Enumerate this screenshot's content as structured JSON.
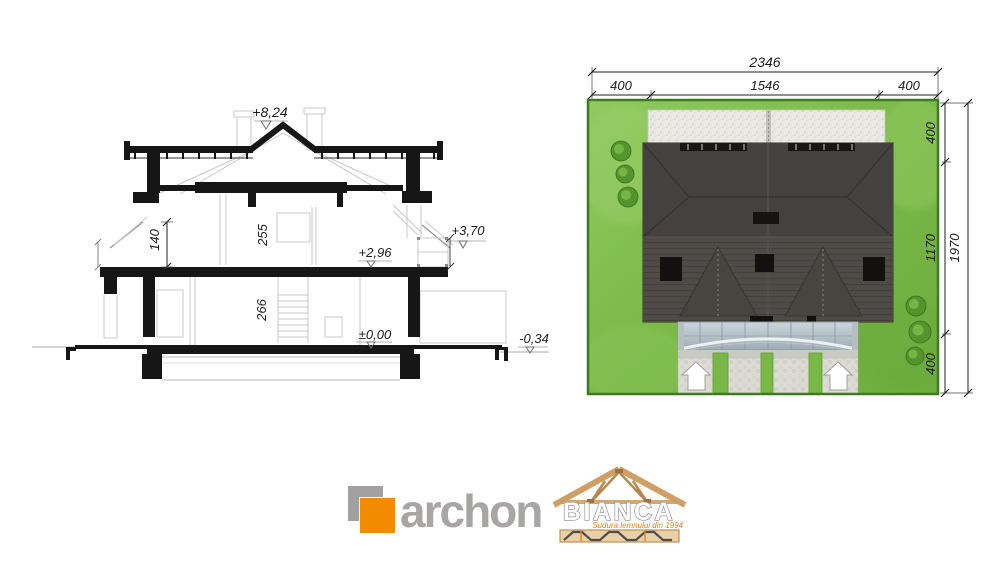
{
  "page": {
    "background": "#ffffff"
  },
  "cross_section": {
    "levels": {
      "ridge": "+8,24",
      "canopy_top": "+3,70",
      "attic_floor": "+2,96",
      "ground_floor": "±0,00",
      "terrace": "-0,34"
    },
    "room_heights": {
      "knee_wall": "140",
      "attic_room": "255",
      "ground_room": "266"
    }
  },
  "site_plan": {
    "dimensions": {
      "plot_width_total": "2346",
      "setback_left": "400",
      "house_width": "1546",
      "setback_right": "400",
      "setback_top": "400",
      "house_depth": "1170",
      "setback_bottom": "400",
      "plot_depth_total": "1970"
    },
    "colors": {
      "lawn": "#7ab848",
      "lawn_border": "#3e7a1f",
      "roof": "#4b4744",
      "gravel": "#e9e8e3",
      "canopy_glass": "#b4c2ca",
      "paving": "#dcdbd4"
    }
  },
  "branding": {
    "archon": {
      "wordmark": "archon",
      "accent_color": "#f28b00",
      "text_color": "#a7a6a4"
    },
    "bianca": {
      "wordmark": "BIANCA",
      "tagline": "Sudura lemnului din 1994",
      "accent_color": "#e8830c",
      "wood_color": "#cf9f66"
    }
  }
}
